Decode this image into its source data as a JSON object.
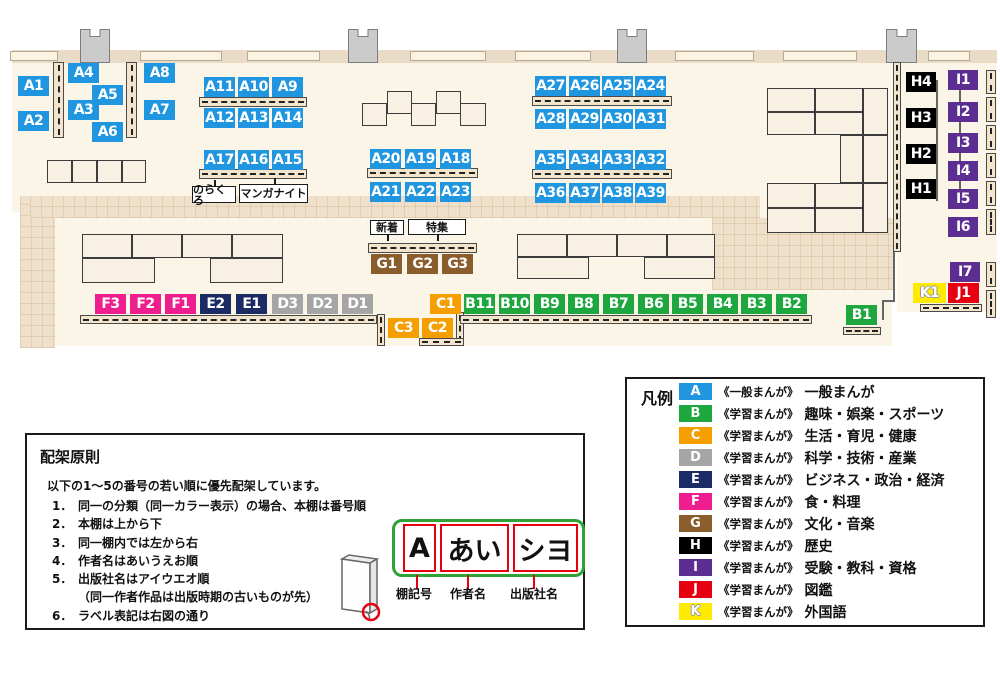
{
  "colors": {
    "A": "#2196e0",
    "B": "#1ea73f",
    "C": "#f59e00",
    "D": "#a5a5a5",
    "E": "#1b2b66",
    "F": "#ee1e8e",
    "G": "#8a5d2c",
    "H": "#000000",
    "I": "#5c2e91",
    "J": "#e60012",
    "K": "#ffeb00",
    "label_box_red": "#e60012",
    "plate_green": "#2fa335"
  },
  "map": {
    "shelves": [
      {
        "id": "A1",
        "cat": "A",
        "x": 18,
        "y": 76
      },
      {
        "id": "A2",
        "cat": "A",
        "x": 18,
        "y": 111
      },
      {
        "id": "A3",
        "cat": "A",
        "x": 68,
        "y": 100
      },
      {
        "id": "A4",
        "cat": "A",
        "x": 68,
        "y": 63
      },
      {
        "id": "A5",
        "cat": "A",
        "x": 92,
        "y": 85
      },
      {
        "id": "A6",
        "cat": "A",
        "x": 92,
        "y": 122
      },
      {
        "id": "A7",
        "cat": "A",
        "x": 144,
        "y": 100
      },
      {
        "id": "A8",
        "cat": "A",
        "x": 144,
        "y": 63
      },
      {
        "id": "A9",
        "cat": "A",
        "x": 272,
        "y": 77
      },
      {
        "id": "A10",
        "cat": "A",
        "x": 238,
        "y": 77
      },
      {
        "id": "A11",
        "cat": "A",
        "x": 204,
        "y": 77
      },
      {
        "id": "A12",
        "cat": "A",
        "x": 204,
        "y": 108
      },
      {
        "id": "A13",
        "cat": "A",
        "x": 238,
        "y": 108
      },
      {
        "id": "A14",
        "cat": "A",
        "x": 272,
        "y": 108
      },
      {
        "id": "A15",
        "cat": "A",
        "x": 272,
        "y": 150
      },
      {
        "id": "A16",
        "cat": "A",
        "x": 238,
        "y": 150
      },
      {
        "id": "A17",
        "cat": "A",
        "x": 204,
        "y": 150
      },
      {
        "id": "A18",
        "cat": "A",
        "x": 440,
        "y": 149
      },
      {
        "id": "A19",
        "cat": "A",
        "x": 405,
        "y": 149
      },
      {
        "id": "A20",
        "cat": "A",
        "x": 370,
        "y": 149
      },
      {
        "id": "A21",
        "cat": "A",
        "x": 370,
        "y": 182
      },
      {
        "id": "A22",
        "cat": "A",
        "x": 405,
        "y": 182
      },
      {
        "id": "A23",
        "cat": "A",
        "x": 440,
        "y": 182
      },
      {
        "id": "A24",
        "cat": "A",
        "x": 635,
        "y": 76
      },
      {
        "id": "A25",
        "cat": "A",
        "x": 602,
        "y": 76
      },
      {
        "id": "A26",
        "cat": "A",
        "x": 569,
        "y": 76
      },
      {
        "id": "A27",
        "cat": "A",
        "x": 535,
        "y": 76
      },
      {
        "id": "A28",
        "cat": "A",
        "x": 535,
        "y": 109
      },
      {
        "id": "A29",
        "cat": "A",
        "x": 569,
        "y": 109
      },
      {
        "id": "A30",
        "cat": "A",
        "x": 602,
        "y": 109
      },
      {
        "id": "A31",
        "cat": "A",
        "x": 635,
        "y": 109
      },
      {
        "id": "A32",
        "cat": "A",
        "x": 635,
        "y": 150
      },
      {
        "id": "A33",
        "cat": "A",
        "x": 602,
        "y": 150
      },
      {
        "id": "A34",
        "cat": "A",
        "x": 569,
        "y": 150
      },
      {
        "id": "A35",
        "cat": "A",
        "x": 535,
        "y": 150
      },
      {
        "id": "A36",
        "cat": "A",
        "x": 535,
        "y": 183
      },
      {
        "id": "A37",
        "cat": "A",
        "x": 569,
        "y": 183
      },
      {
        "id": "A38",
        "cat": "A",
        "x": 602,
        "y": 183
      },
      {
        "id": "A39",
        "cat": "A",
        "x": 635,
        "y": 183
      },
      {
        "id": "B1",
        "cat": "B",
        "x": 846,
        "y": 305
      },
      {
        "id": "B2",
        "cat": "B",
        "x": 776,
        "y": 294
      },
      {
        "id": "B3",
        "cat": "B",
        "x": 741,
        "y": 294
      },
      {
        "id": "B4",
        "cat": "B",
        "x": 707,
        "y": 294
      },
      {
        "id": "B5",
        "cat": "B",
        "x": 672,
        "y": 294
      },
      {
        "id": "B6",
        "cat": "B",
        "x": 638,
        "y": 294
      },
      {
        "id": "B7",
        "cat": "B",
        "x": 603,
        "y": 294
      },
      {
        "id": "B8",
        "cat": "B",
        "x": 568,
        "y": 294
      },
      {
        "id": "B9",
        "cat": "B",
        "x": 534,
        "y": 294
      },
      {
        "id": "B10",
        "cat": "B",
        "x": 499,
        "y": 294
      },
      {
        "id": "B11",
        "cat": "B",
        "x": 464,
        "y": 294
      },
      {
        "id": "C1",
        "cat": "C",
        "x": 430,
        "y": 294
      },
      {
        "id": "C2",
        "cat": "C",
        "x": 422,
        "y": 318
      },
      {
        "id": "C3",
        "cat": "C",
        "x": 388,
        "y": 318
      },
      {
        "id": "D1",
        "cat": "D",
        "x": 342,
        "y": 294
      },
      {
        "id": "D2",
        "cat": "D",
        "x": 307,
        "y": 294
      },
      {
        "id": "D3",
        "cat": "D",
        "x": 272,
        "y": 294
      },
      {
        "id": "E1",
        "cat": "E",
        "x": 236,
        "y": 294
      },
      {
        "id": "E2",
        "cat": "E",
        "x": 200,
        "y": 294
      },
      {
        "id": "F1",
        "cat": "F",
        "x": 165,
        "y": 294
      },
      {
        "id": "F2",
        "cat": "F",
        "x": 130,
        "y": 294
      },
      {
        "id": "F3",
        "cat": "F",
        "x": 95,
        "y": 294
      },
      {
        "id": "G1",
        "cat": "G",
        "x": 371,
        "y": 254
      },
      {
        "id": "G2",
        "cat": "G",
        "x": 407,
        "y": 254
      },
      {
        "id": "G3",
        "cat": "G",
        "x": 442,
        "y": 254
      },
      {
        "id": "H1",
        "cat": "H",
        "x": 906,
        "y": 179,
        "w": 30
      },
      {
        "id": "H2",
        "cat": "H",
        "x": 906,
        "y": 144,
        "w": 30
      },
      {
        "id": "H3",
        "cat": "H",
        "x": 906,
        "y": 108,
        "w": 30
      },
      {
        "id": "H4",
        "cat": "H",
        "x": 906,
        "y": 72,
        "w": 30
      },
      {
        "id": "I1",
        "cat": "I",
        "x": 948,
        "y": 70,
        "w": 30
      },
      {
        "id": "I2",
        "cat": "I",
        "x": 948,
        "y": 102,
        "w": 30
      },
      {
        "id": "I3",
        "cat": "I",
        "x": 948,
        "y": 133,
        "w": 30
      },
      {
        "id": "I4",
        "cat": "I",
        "x": 948,
        "y": 161,
        "w": 30
      },
      {
        "id": "I5",
        "cat": "I",
        "x": 948,
        "y": 189,
        "w": 30
      },
      {
        "id": "I6",
        "cat": "I",
        "x": 948,
        "y": 217,
        "w": 30
      },
      {
        "id": "I7",
        "cat": "I",
        "x": 950,
        "y": 262,
        "w": 30
      },
      {
        "id": "J1",
        "cat": "J",
        "x": 948,
        "y": 283
      },
      {
        "id": "K1",
        "cat": "K",
        "x": 913,
        "y": 283,
        "w": 33
      }
    ],
    "callouts": [
      {
        "text": "のらくろ",
        "x": 192,
        "y": 186,
        "w": 44,
        "h": 17,
        "tail": "up"
      },
      {
        "text": "マンガナイト",
        "x": 239,
        "y": 184,
        "w": 69,
        "h": 19,
        "tail": "up"
      },
      {
        "text": "新着",
        "x": 370,
        "y": 220,
        "w": 34,
        "h": 15,
        "tail": "down"
      },
      {
        "text": "特集",
        "x": 408,
        "y": 219,
        "w": 58,
        "h": 16,
        "tail": "down"
      }
    ]
  },
  "legend": {
    "title": "凡例",
    "items": [
      {
        "key": "A",
        "scope": "《一般まんが》",
        "label": "一般まんが"
      },
      {
        "key": "B",
        "scope": "《学習まんが》",
        "label": "趣味・娯楽・スポーツ"
      },
      {
        "key": "C",
        "scope": "《学習まんが》",
        "label": "生活・育児・健康"
      },
      {
        "key": "D",
        "scope": "《学習まんが》",
        "label": "科学・技術・産業"
      },
      {
        "key": "E",
        "scope": "《学習まんが》",
        "label": "ビジネス・政治・経済"
      },
      {
        "key": "F",
        "scope": "《学習まんが》",
        "label": "食・料理"
      },
      {
        "key": "G",
        "scope": "《学習まんが》",
        "label": "文化・音楽"
      },
      {
        "key": "H",
        "scope": "《学習まんが》",
        "label": "歴史"
      },
      {
        "key": "I",
        "scope": "《学習まんが》",
        "label": "受験・教科・資格"
      },
      {
        "key": "J",
        "scope": "《学習まんが》",
        "label": "図鑑"
      },
      {
        "key": "K",
        "scope": "《学習まんが》",
        "label": "外国語"
      }
    ]
  },
  "principles": {
    "title": "配架原則",
    "intro": "以下の1～5の番号の若い順に優先配架しています。",
    "items": [
      {
        "num": "1．",
        "text": "同一の分類（同一カラー表示）の場合、本棚は番号順"
      },
      {
        "num": "2．",
        "text": "本棚は上から下"
      },
      {
        "num": "3．",
        "text": "同一棚内では左から右"
      },
      {
        "num": "4．",
        "text": "作者名はあいうえお順"
      },
      {
        "num": "5．",
        "text": "出版社名はアイウエオ順"
      },
      {
        "num": "",
        "text": "（同一作者作品は出版時期の古いものが先）"
      },
      {
        "num": "6．",
        "text": "ラベル表記は右図の通り"
      }
    ],
    "label_example": {
      "shelf_code": "A",
      "author": "あい",
      "publisher": "シヨ",
      "captions": [
        "棚記号",
        "作者名",
        "出版社名"
      ]
    }
  }
}
